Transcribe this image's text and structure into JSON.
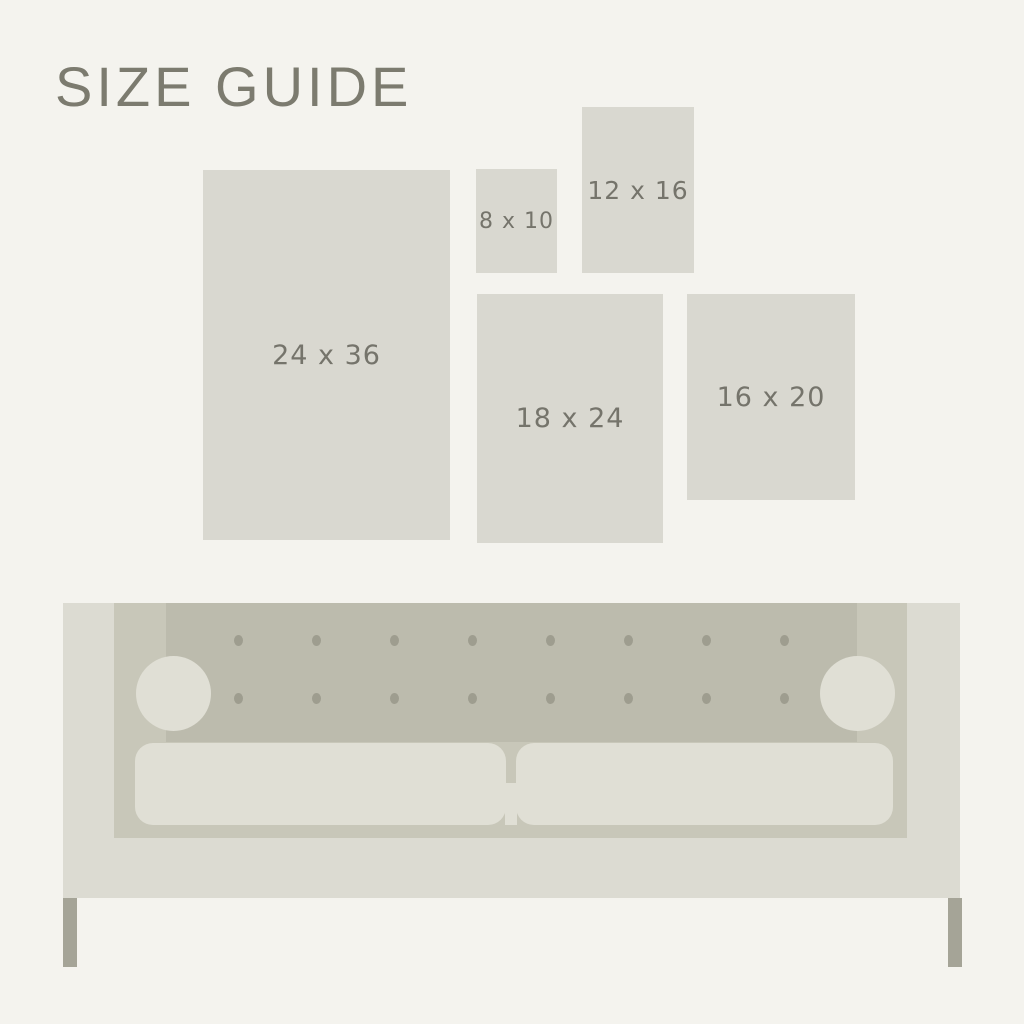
{
  "title": "SIZE GUIDE",
  "sizes": [
    {
      "label": "24 x 36",
      "width_in": 24,
      "height_in": 36
    },
    {
      "label": "8 x 10",
      "width_in": 8,
      "height_in": 10
    },
    {
      "label": "12 x 16",
      "width_in": 12,
      "height_in": 16
    },
    {
      "label": "18 x 24",
      "width_in": 18,
      "height_in": 24
    },
    {
      "label": "16 x 20",
      "width_in": 16,
      "height_in": 20
    }
  ],
  "colors": {
    "background": "#f4f3ee",
    "swatch_fill": "#d9d8d0",
    "title_text": "#7c7b6f",
    "label_text": "#75746b",
    "sofa_body": "#dcdbd2",
    "sofa_inner_frame": "#c8c7b9",
    "sofa_back_panel": "#bcbbad",
    "tufting_button": "#9e9d8f",
    "cushion": "#e0dfd5",
    "leg": "#a5a497"
  },
  "couch": {
    "tufting": {
      "rows": 2,
      "cols": 8,
      "start_x": 238,
      "start_y": 640,
      "step_x": 78,
      "step_y": 58
    }
  }
}
